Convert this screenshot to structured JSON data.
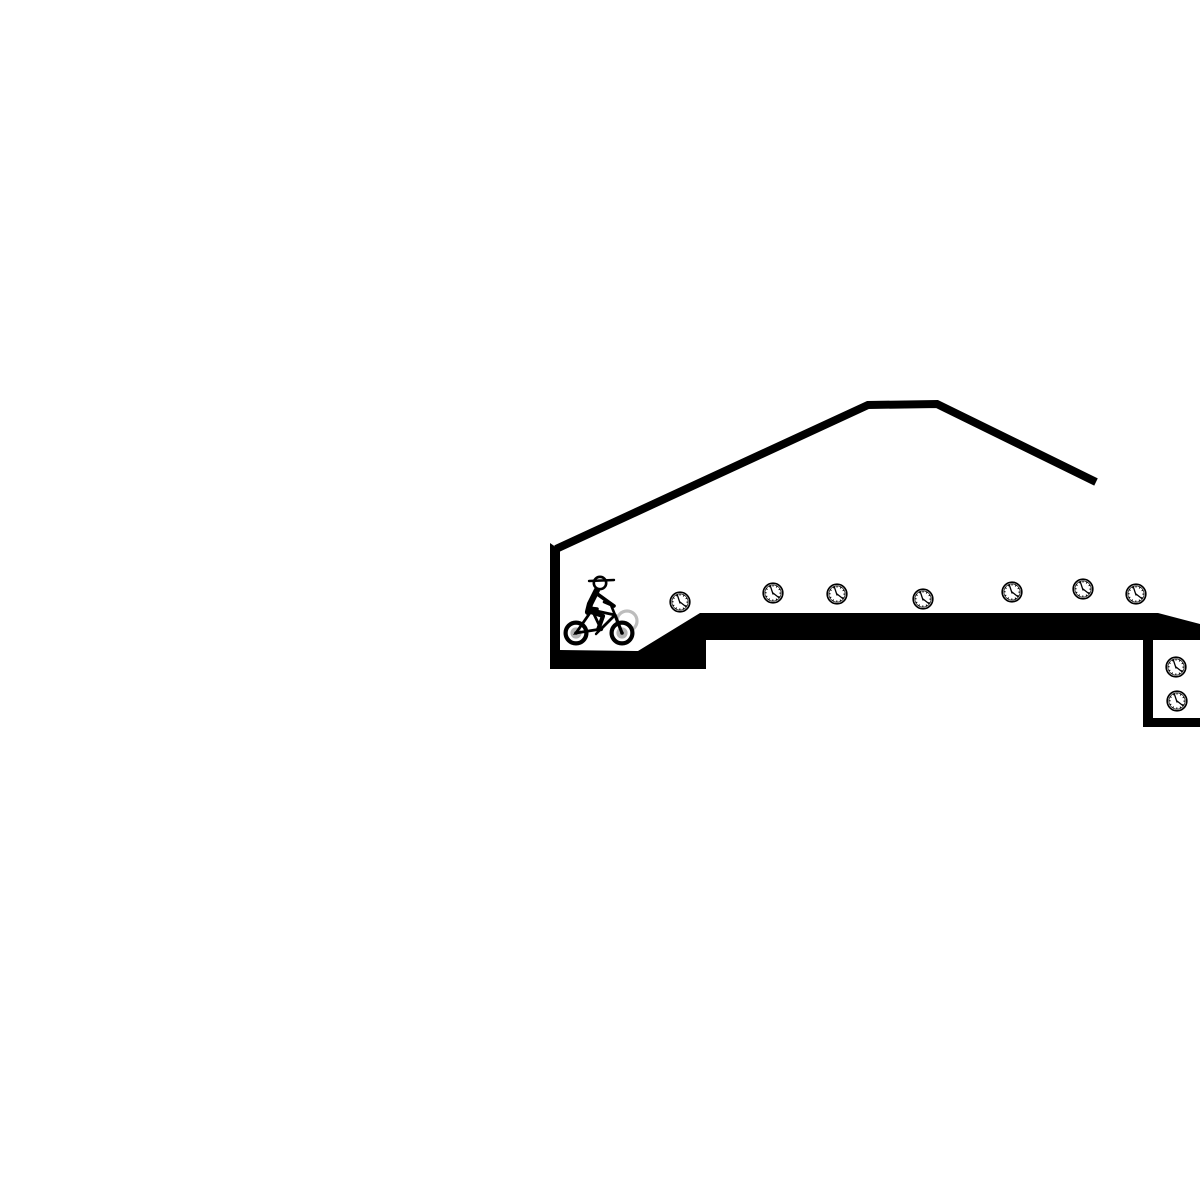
{
  "app": {
    "name": "bike-trials-level",
    "description": "Monochrome side-scrolling bike trials game scene with a rider at the start wall, clock pickups along a platform, a roof line, and a clock pit on the right"
  },
  "scene": {
    "canvas": {
      "width": 1200,
      "height": 1200,
      "background": "#ffffff"
    },
    "colors": {
      "ink": "#000000",
      "background": "#ffffff",
      "wheel_hub": "#b3b3b3",
      "ghost_wheel": "#bdbdbd"
    },
    "terrain": {
      "fill": "#000000",
      "path": "M550,543 L550,669 L706,669 L706,640 L1143,640 L1143,727 L1200,727 L1200,718 L1153,718 L1153,640 L1200,640 L1200,624 L1158,613 L700,613 L638,651 L560,650 L560,550 Z"
    },
    "roof": {
      "points": "556,549 868,405 937,404 1096,482",
      "stroke_width": 8
    },
    "clocks": [
      {
        "x": 680,
        "y": 602
      },
      {
        "x": 773,
        "y": 593
      },
      {
        "x": 837,
        "y": 594
      },
      {
        "x": 923,
        "y": 599
      },
      {
        "x": 1012,
        "y": 592
      },
      {
        "x": 1083,
        "y": 589
      },
      {
        "x": 1136,
        "y": 594
      },
      {
        "x": 1176,
        "y": 667
      },
      {
        "x": 1177,
        "y": 701
      }
    ],
    "clock_count": 9,
    "rider": {
      "x": 576,
      "y": 633,
      "facing": "right"
    }
  }
}
